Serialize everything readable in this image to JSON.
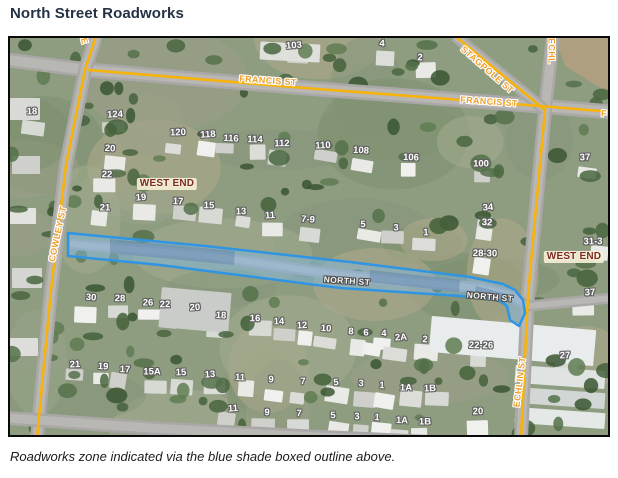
{
  "page": {
    "title": "North Street Roadworks",
    "caption": "Roadworks zone indicated via the blue shade boxed outline above."
  },
  "colors": {
    "route_line": "#f7b309",
    "road_gray": "#a9a8a6",
    "zone_stroke": "#2f95e3",
    "zone_fill": "rgba(125,183,235,0.45)",
    "street_text": "#ef9f2a",
    "suburb_text": "#7d2b1d"
  },
  "map": {
    "roads_gray": [
      {
        "name": "francis-st-road",
        "w": 15,
        "pts": [
          [
            -2,
            22
          ],
          [
            78,
            32
          ],
          [
            295,
            50
          ],
          [
            530,
            68
          ],
          [
            602,
            74
          ]
        ]
      },
      {
        "name": "cowley-st-road",
        "w": 14,
        "pts": [
          [
            86,
            -2
          ],
          [
            75,
            32
          ],
          [
            56,
            127
          ],
          [
            41,
            252
          ],
          [
            27,
            400
          ]
        ]
      },
      {
        "name": "echlin-st-road",
        "w": 14,
        "pts": [
          [
            543,
            -2
          ],
          [
            535,
            72
          ],
          [
            518,
            257
          ],
          [
            511,
            400
          ]
        ]
      },
      {
        "name": "stagpole-st-road",
        "w": 12,
        "pts": [
          [
            445,
            -2
          ],
          [
            535,
            72
          ]
        ]
      },
      {
        "name": "north-st-road",
        "w": 11,
        "pts": [
          [
            60,
            206
          ],
          [
            200,
            218
          ],
          [
            330,
            237
          ],
          [
            470,
            250
          ],
          [
            500,
            257
          ],
          [
            518,
            268
          ],
          [
            602,
            260
          ]
        ]
      },
      {
        "name": "south-street-road",
        "w": 14,
        "pts": [
          [
            -2,
            380
          ],
          [
            140,
            390
          ],
          [
            290,
            398
          ],
          [
            420,
            404
          ]
        ]
      }
    ],
    "routes_yellow": [
      {
        "name": "francis-st-route",
        "pts": [
          [
            78,
            32
          ],
          [
            295,
            50
          ],
          [
            530,
            68
          ],
          [
            602,
            74
          ]
        ]
      },
      {
        "name": "cowley-st-route",
        "pts": [
          [
            86,
            -2
          ],
          [
            75,
            32
          ],
          [
            56,
            127
          ],
          [
            41,
            252
          ],
          [
            27,
            400
          ]
        ]
      },
      {
        "name": "stagpole-st-route",
        "pts": [
          [
            445,
            -2
          ],
          [
            535,
            72
          ]
        ]
      },
      {
        "name": "echlin-st-route",
        "pts": [
          [
            535,
            72
          ],
          [
            518,
            257
          ],
          [
            511,
            400
          ]
        ]
      }
    ],
    "roadworks_zone": {
      "outline": [
        [
          58,
          195
        ],
        [
          195,
          208
        ],
        [
          340,
          224
        ],
        [
          460,
          239
        ],
        [
          493,
          246
        ],
        [
          505,
          252
        ],
        [
          513,
          262
        ],
        [
          515,
          275
        ],
        [
          509,
          288
        ],
        [
          500,
          282
        ],
        [
          497,
          268
        ],
        [
          488,
          262
        ],
        [
          450,
          258
        ],
        [
          330,
          250
        ],
        [
          150,
          227
        ],
        [
          58,
          218
        ]
      ],
      "dark_patches": [
        [
          [
            100,
            201
          ],
          [
            225,
            213
          ],
          [
            224,
            227
          ],
          [
            100,
            215
          ]
        ],
        [
          [
            360,
            232
          ],
          [
            450,
            242
          ],
          [
            449,
            254
          ],
          [
            359,
            244
          ]
        ],
        [
          [
            466,
            248
          ],
          [
            497,
            256
          ],
          [
            495,
            266
          ],
          [
            464,
            258
          ]
        ]
      ]
    },
    "street_labels": [
      {
        "name": "francis-st-label-1",
        "text": "FRANCIS ST",
        "style": "route",
        "x": 258,
        "y": 43,
        "rot": 4
      },
      {
        "name": "francis-st-label-2",
        "text": "FRANCIS ST",
        "style": "route",
        "x": 479,
        "y": 64,
        "rot": 4
      },
      {
        "name": "francis-st-label-clipped",
        "text": "F",
        "style": "route",
        "x": 594,
        "y": 76,
        "rot": 4
      },
      {
        "name": "cowley-st-label",
        "text": "COWLEY ST",
        "style": "route",
        "x": 48,
        "y": 196,
        "rot": -78
      },
      {
        "name": "stagpole-st-label",
        "text": "STAGPOLE ST",
        "style": "route",
        "x": 477,
        "y": 32,
        "rot": 41
      },
      {
        "name": "echlin-st-label-top",
        "text": "ECHL",
        "style": "route",
        "x": 541,
        "y": 13,
        "rot": 90
      },
      {
        "name": "echlin-st-label",
        "text": "ECHLIN ST",
        "style": "route",
        "x": 510,
        "y": 344,
        "rot": -83
      },
      {
        "name": "street-label-fragment",
        "text": "E",
        "style": "route",
        "x": 74,
        "y": 3,
        "rot": 75
      },
      {
        "name": "north-st-label-1",
        "text": "NORTH ST",
        "style": "minor",
        "x": 337,
        "y": 243,
        "rot": 4
      },
      {
        "name": "north-st-label-2",
        "text": "NORTH ST",
        "style": "minor",
        "x": 480,
        "y": 259,
        "rot": 5
      },
      {
        "name": "west-end-label-1",
        "text": "WEST END",
        "style": "suburb",
        "x": 157,
        "y": 146,
        "rot": 0
      },
      {
        "name": "west-end-label-2",
        "text": "WEST END",
        "style": "suburb",
        "x": 564,
        "y": 219,
        "rot": 0
      }
    ],
    "house_numbers": [
      {
        "text": "103",
        "x": 284,
        "y": 8
      },
      {
        "text": "4",
        "x": 372,
        "y": 6
      },
      {
        "text": "2",
        "x": 410,
        "y": 20
      },
      {
        "text": "18",
        "x": 22,
        "y": 74
      },
      {
        "text": "124",
        "x": 105,
        "y": 77
      },
      {
        "text": "20",
        "x": 100,
        "y": 111
      },
      {
        "text": "22",
        "x": 97,
        "y": 137
      },
      {
        "text": "21",
        "x": 95,
        "y": 170
      },
      {
        "text": "120",
        "x": 168,
        "y": 95
      },
      {
        "text": "118",
        "x": 198,
        "y": 97
      },
      {
        "text": "116",
        "x": 221,
        "y": 101
      },
      {
        "text": "114",
        "x": 245,
        "y": 102
      },
      {
        "text": "112",
        "x": 272,
        "y": 106
      },
      {
        "text": "110",
        "x": 313,
        "y": 108
      },
      {
        "text": "108",
        "x": 351,
        "y": 113
      },
      {
        "text": "106",
        "x": 401,
        "y": 120
      },
      {
        "text": "100",
        "x": 471,
        "y": 126
      },
      {
        "text": "37",
        "x": 575,
        "y": 120
      },
      {
        "text": "19",
        "x": 131,
        "y": 160
      },
      {
        "text": "17",
        "x": 168,
        "y": 164
      },
      {
        "text": "15",
        "x": 199,
        "y": 168
      },
      {
        "text": "13",
        "x": 231,
        "y": 174
      },
      {
        "text": "11",
        "x": 260,
        "y": 178
      },
      {
        "text": "7-9",
        "x": 298,
        "y": 182
      },
      {
        "text": "5",
        "x": 353,
        "y": 187
      },
      {
        "text": "3",
        "x": 386,
        "y": 190
      },
      {
        "text": "1",
        "x": 416,
        "y": 195
      },
      {
        "text": "34",
        "x": 478,
        "y": 170
      },
      {
        "text": "32",
        "x": 477,
        "y": 185
      },
      {
        "text": "28-30",
        "x": 475,
        "y": 216
      },
      {
        "text": "31-3",
        "x": 583,
        "y": 204
      },
      {
        "text": "37",
        "x": 580,
        "y": 255
      },
      {
        "text": "30",
        "x": 81,
        "y": 260
      },
      {
        "text": "28",
        "x": 110,
        "y": 261
      },
      {
        "text": "26",
        "x": 138,
        "y": 265
      },
      {
        "text": "22",
        "x": 155,
        "y": 267
      },
      {
        "text": "20",
        "x": 185,
        "y": 270
      },
      {
        "text": "18",
        "x": 211,
        "y": 278
      },
      {
        "text": "16",
        "x": 245,
        "y": 281
      },
      {
        "text": "14",
        "x": 269,
        "y": 284
      },
      {
        "text": "12",
        "x": 292,
        "y": 288
      },
      {
        "text": "10",
        "x": 316,
        "y": 291
      },
      {
        "text": "8",
        "x": 341,
        "y": 294
      },
      {
        "text": "6",
        "x": 356,
        "y": 295
      },
      {
        "text": "4",
        "x": 374,
        "y": 296
      },
      {
        "text": "2A",
        "x": 391,
        "y": 300
      },
      {
        "text": "2",
        "x": 415,
        "y": 302
      },
      {
        "text": "22-26",
        "x": 471,
        "y": 308
      },
      {
        "text": "27",
        "x": 555,
        "y": 318
      },
      {
        "text": "21",
        "x": 65,
        "y": 327
      },
      {
        "text": "19",
        "x": 93,
        "y": 329
      },
      {
        "text": "17",
        "x": 115,
        "y": 332
      },
      {
        "text": "15A",
        "x": 142,
        "y": 334
      },
      {
        "text": "15",
        "x": 171,
        "y": 335
      },
      {
        "text": "13",
        "x": 200,
        "y": 337
      },
      {
        "text": "11",
        "x": 230,
        "y": 340
      },
      {
        "text": "9",
        "x": 261,
        "y": 342
      },
      {
        "text": "7",
        "x": 293,
        "y": 344
      },
      {
        "text": "5",
        "x": 326,
        "y": 345
      },
      {
        "text": "3",
        "x": 351,
        "y": 346
      },
      {
        "text": "1",
        "x": 372,
        "y": 348
      },
      {
        "text": "1A",
        "x": 396,
        "y": 350
      },
      {
        "text": "1B",
        "x": 420,
        "y": 351
      },
      {
        "text": "11",
        "x": 223,
        "y": 371
      },
      {
        "text": "9",
        "x": 257,
        "y": 375
      },
      {
        "text": "7",
        "x": 289,
        "y": 376
      },
      {
        "text": "5",
        "x": 323,
        "y": 378
      },
      {
        "text": "3",
        "x": 347,
        "y": 379
      },
      {
        "text": "1",
        "x": 367,
        "y": 380
      },
      {
        "text": "1A",
        "x": 392,
        "y": 383
      },
      {
        "text": "1B",
        "x": 415,
        "y": 384
      },
      {
        "text": "20",
        "x": 468,
        "y": 374
      }
    ]
  }
}
